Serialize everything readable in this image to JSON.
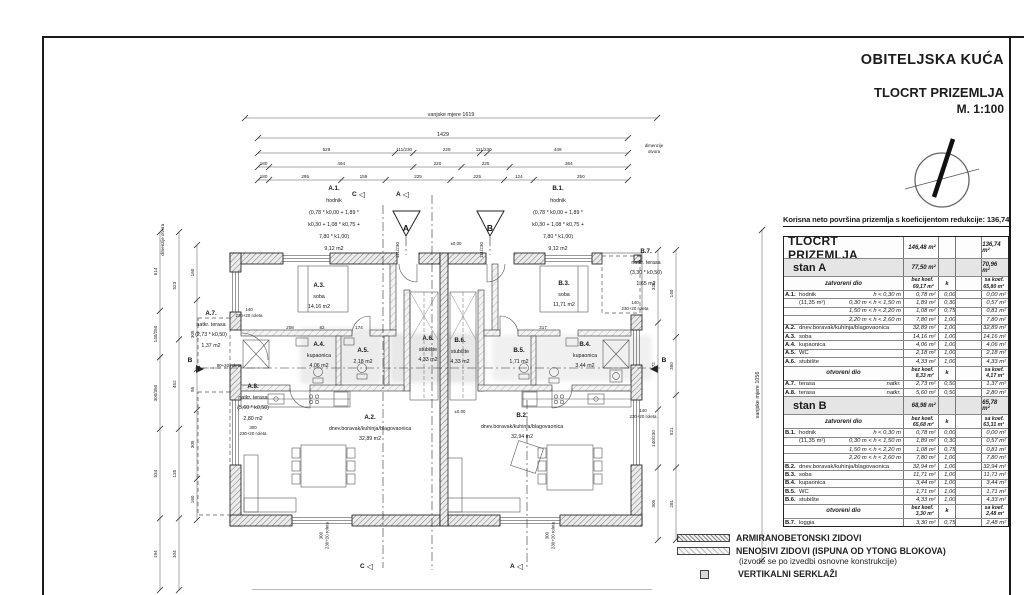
{
  "title_block": {
    "line1": "OBITELJSKA KUĆA",
    "line2": "TLOCRT PRIZEMLJA",
    "line3": "M. 1:100"
  },
  "summary_note": "Korisna neto površina prizemlja s koeficijentom redukcije: 136,74 m2",
  "table": {
    "title_row": {
      "label": "TLOCRT PRIZEMLJA",
      "bez": "146,48 m²",
      "sa": "136,74 m²"
    },
    "sections": [
      {
        "type": "stan",
        "label": "stan A",
        "bez": "77,50 m²",
        "sa": "70,96 m²"
      },
      {
        "type": "subhead",
        "label": "zatvoreni dio",
        "bez_top": "bez koef.",
        "bez_val": "69,17 m²",
        "k": "k",
        "sa_top": "sa koef.",
        "sa_val": "65,80 m²"
      },
      {
        "type": "row",
        "id": "A.1.",
        "name": "hodnik",
        "range": "h < 0,30 m",
        "bez": "0,78 m²",
        "k": "0,00",
        "sa": "0,00 m²"
      },
      {
        "type": "row",
        "id": "",
        "name": "(11,35 m²)",
        "range": "0,30 m < h < 1,50 m",
        "bez": "1,89 m²",
        "k": "0,30",
        "sa": "0,57 m²"
      },
      {
        "type": "row",
        "id": "",
        "name": "",
        "range": "1,50 m < h < 2,20 m",
        "bez": "1,08 m²",
        "k": "0,75",
        "sa": "0,81 m²"
      },
      {
        "type": "row",
        "id": "",
        "name": "",
        "range": "2,20 m < h < 2,60 m",
        "bez": "7,80 m²",
        "k": "1,00",
        "sa": "7,80 m²"
      },
      {
        "type": "row",
        "id": "A.2.",
        "name": "dnev.boravak/kuhinja/blagovaonica",
        "range": "",
        "bez": "32,89 m²",
        "k": "1,00",
        "sa": "32,89 m²"
      },
      {
        "type": "row",
        "id": "A.3.",
        "name": "soba",
        "range": "",
        "bez": "14,16 m²",
        "k": "1,00",
        "sa": "14,16 m²"
      },
      {
        "type": "row",
        "id": "A.4.",
        "name": "kupaonica",
        "range": "",
        "bez": "4,06 m²",
        "k": "1,00",
        "sa": "4,06 m²"
      },
      {
        "type": "row",
        "id": "A.5.",
        "name": "WC",
        "range": "",
        "bez": "2,18 m²",
        "k": "1,00",
        "sa": "2,18 m²"
      },
      {
        "type": "row",
        "id": "A.6.",
        "name": "stubište",
        "range": "",
        "bez": "4,33 m²",
        "k": "1,00",
        "sa": "4,33 m²"
      },
      {
        "type": "subhead",
        "label": "otvoreni dio",
        "bez_top": "bez koef.",
        "bez_val": "8,33 m²",
        "k": "k",
        "sa_top": "sa koef.",
        "sa_val": "4,17 m²"
      },
      {
        "type": "row",
        "id": "A.7.",
        "name": "terasa",
        "range": "natkr.",
        "bez": "2,73 m²",
        "k": "0,50",
        "sa": "1,37 m²"
      },
      {
        "type": "row",
        "id": "A.8.",
        "name": "terasa",
        "range": "natkr.",
        "bez": "5,60 m²",
        "k": "0,50",
        "sa": "2,80 m²"
      },
      {
        "type": "stan",
        "label": "stan B",
        "bez": "68,98 m²",
        "sa": "65,78 m²"
      },
      {
        "type": "subhead",
        "label": "zatvoreni dio",
        "bez_top": "bez koef.",
        "bez_val": "65,68 m²",
        "k": "k",
        "sa_top": "sa koef.",
        "sa_val": "63,31 m²"
      },
      {
        "type": "row",
        "id": "B.1.",
        "name": "hodnik",
        "range": "h < 0,30 m",
        "bez": "0,78 m²",
        "k": "0,00",
        "sa": "0,00 m²"
      },
      {
        "type": "row",
        "id": "",
        "name": "(11,35 m²)",
        "range": "0,30 m < h < 1,50 m",
        "bez": "1,89 m²",
        "k": "0,30",
        "sa": "0,57 m²"
      },
      {
        "type": "row",
        "id": "",
        "name": "",
        "range": "1,50 m < h < 2,20 m",
        "bez": "1,08 m²",
        "k": "0,75",
        "sa": "0,81 m²"
      },
      {
        "type": "row",
        "id": "",
        "name": "",
        "range": "2,20 m < h < 2,60 m",
        "bez": "7,80 m²",
        "k": "1,00",
        "sa": "7,80 m²"
      },
      {
        "type": "row",
        "id": "B.2.",
        "name": "dnev.boravak/kuhinja/blagovaonica",
        "range": "",
        "bez": "32,94 m²",
        "k": "1,00",
        "sa": "32,94 m²"
      },
      {
        "type": "row",
        "id": "B.3.",
        "name": "soba",
        "range": "",
        "bez": "11,71 m²",
        "k": "1,00",
        "sa": "11,71 m²"
      },
      {
        "type": "row",
        "id": "B.4.",
        "name": "kupaonica",
        "range": "",
        "bez": "3,44 m²",
        "k": "1,00",
        "sa": "3,44 m²"
      },
      {
        "type": "row",
        "id": "B.5.",
        "name": "WC",
        "range": "",
        "bez": "1,71 m²",
        "k": "1,00",
        "sa": "1,71 m²"
      },
      {
        "type": "row",
        "id": "B.6.",
        "name": "stubište",
        "range": "",
        "bez": "4,33 m²",
        "k": "1,00",
        "sa": "4,33 m²"
      },
      {
        "type": "subhead",
        "label": "otvoreni dio",
        "bez_top": "bez koef.",
        "bez_val": "3,30 m²",
        "k": "k",
        "sa_top": "sa koef.",
        "sa_val": "2,48 m²"
      },
      {
        "type": "row",
        "id": "B.7.",
        "name": "loggia",
        "range": "",
        "bez": "3,30 m²",
        "k": "0,75",
        "sa": "2,48 m²"
      }
    ]
  },
  "legend": {
    "items": [
      {
        "swatch": "dense",
        "label": "ARMIRANOBETONSKI ZIDOVI"
      },
      {
        "swatch": "light",
        "label": "NENOSIVI ZIDOVI (ISPUNA OD YTONG BLOKOVA)",
        "label2": "(izvode se po izvedbi osnovne konstrukcije)"
      },
      {
        "swatch": "square",
        "label": "VERTIKALNI SERKLAŽI"
      }
    ]
  },
  "plan_labels": {
    "a1": {
      "lines": [
        "A.1.",
        "hodnik",
        "(0,78 * k0,00 + 1,89 *",
        "k0,30 + 1,08 * k0,75 +",
        "7,80 * k1,00)",
        "9,12 m2"
      ]
    },
    "b1": {
      "lines": [
        "B.1.",
        "hodnik",
        "(0,78 * k0,00 + 1,89 *",
        "k0,30 + 1,08 * k0,75 +",
        "7,80 * k1,00)",
        "9,12 m2"
      ]
    },
    "a2": {
      "lines": [
        "A.2.",
        "dnev.boravak/kuhinja/blagovaonica",
        "32,89 m2"
      ]
    },
    "b2": {
      "lines": [
        "B.2.",
        "dnev.boravak/kuhinja/blagovaonica",
        "32,94 m2"
      ]
    },
    "a3": {
      "lines": [
        "A.3.",
        "soba",
        "14,16 m2"
      ]
    },
    "b3": {
      "lines": [
        "B.3.",
        "soba",
        "11,71 m2"
      ]
    },
    "a4": {
      "lines": [
        "A.4.",
        "kupaonica",
        "4,06 m2"
      ]
    },
    "a5": {
      "lines": [
        "A.5.",
        "2,18 m2"
      ]
    },
    "a6": {
      "lines": [
        "A.6.",
        "stubište",
        "4,33 m2"
      ]
    },
    "b6": {
      "lines": [
        "B.6.",
        "stubište",
        "4,33 m2"
      ]
    },
    "b5": {
      "lines": [
        "B.5.",
        "1,71 m2"
      ]
    },
    "b4": {
      "lines": [
        "B.4.",
        "kupaonica",
        "3,44 m2"
      ]
    },
    "a7": {
      "lines": [
        "A.7.",
        "natkr. terasa",
        "(2,73 * k0,50)",
        "1,37 m2"
      ]
    },
    "a8": {
      "lines": [
        "A.8.",
        "natkr. terasa",
        "(5,60 * k0,50)",
        "2,80 m2"
      ]
    },
    "b7": {
      "lines": [
        "B.7.",
        "natkr. terasa",
        "(3,30 * k0,50)",
        "1,65 m2"
      ]
    },
    "n_a7": {
      "lines": [
        "140",
        "230+20 roleta"
      ]
    },
    "n_90": {
      "lines": [
        "90+20 roleta"
      ]
    },
    "n_a8": {
      "lines": [
        "300",
        "230+20 roleta"
      ]
    },
    "n_b7": {
      "lines": [
        "140",
        "230+20 roleta"
      ]
    },
    "n_b2": {
      "lines": [
        "140",
        "230+20 roleta"
      ]
    },
    "n_bl": {
      "lines": [
        "300",
        "230+20 roleta"
      ]
    },
    "n_br": {
      "lines": [
        "300",
        "230+20 roleta"
      ]
    },
    "dim_r": {
      "lines": [
        "dimenzije",
        "otvora"
      ]
    },
    "dim_l": {
      "lines": [
        "dimenzije otvora"
      ]
    },
    "lvl1": {
      "lines": [
        "±0,00"
      ]
    },
    "lvl2": {
      "lines": [
        "±0,00"
      ]
    }
  },
  "dimensions": {
    "top": [
      [
        "vanjske mjere 1619"
      ],
      [
        "1429"
      ],
      [
        "529",
        "111/230",
        "229",
        "111/230",
        "449"
      ],
      [
        "180",
        "494",
        "220",
        "225",
        "364"
      ],
      [
        "180",
        "295",
        "159",
        "225",
        "225",
        "124",
        "250"
      ]
    ],
    "left": [
      [
        "514",
        "140/250",
        "300/350",
        "534",
        "194"
      ],
      [
        "523",
        "452",
        "135",
        "104"
      ],
      [
        "160",
        "305",
        "95",
        "305",
        "160"
      ]
    ],
    "right": [
      [
        "325",
        "472",
        "140/230",
        "305"
      ],
      [
        "140",
        "350",
        "521",
        "281"
      ],
      [
        "vanjske mjere 1056"
      ]
    ],
    "interior": [
      "208",
      "82",
      "174",
      "317"
    ],
    "door_height_a": "111/230",
    "door_height_b": "111/230"
  },
  "markers": {
    "c": "C",
    "a": "A",
    "b": "B",
    "entrance_a": "A",
    "entrance_b": "B"
  },
  "icons": {
    "tri_left": "◁",
    "tri_right": "▷"
  },
  "colors": {
    "line": "#1a1a1a",
    "wall_hatch": "#8a8a8a",
    "stan_row_bg": "#e5e5e5"
  }
}
